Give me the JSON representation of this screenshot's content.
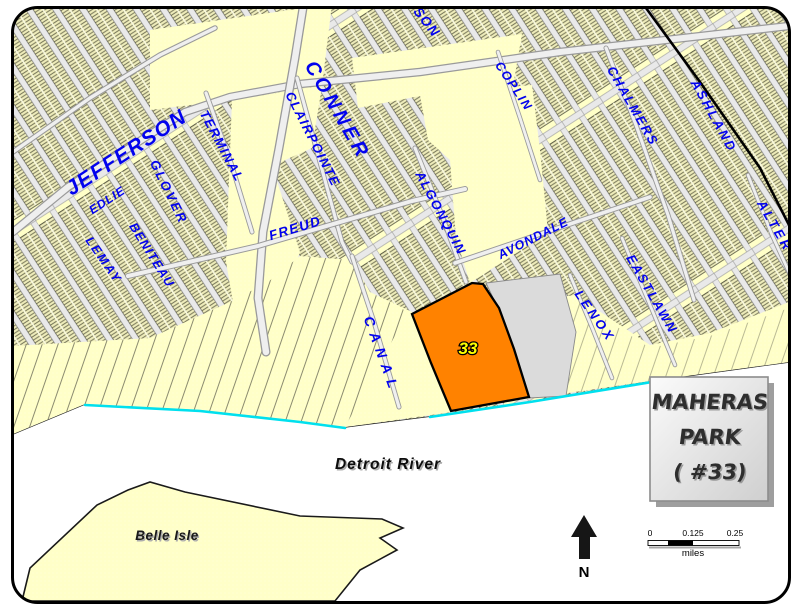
{
  "streets": [
    {
      "name": "JEFFERSON"
    },
    {
      "name": "CONNER"
    },
    {
      "name": "TERMINAL"
    },
    {
      "name": "CLAIRPOINTE"
    },
    {
      "name": "GLOVER"
    },
    {
      "name": "EDLIE"
    },
    {
      "name": "BENITEAU"
    },
    {
      "name": "LEMAY"
    },
    {
      "name": "FREUD"
    },
    {
      "name": "CANAL"
    },
    {
      "name": "ALGONQUIN"
    },
    {
      "name": "AVONDALE"
    },
    {
      "name": "COPLIN"
    },
    {
      "name": "CHALMERS"
    },
    {
      "name": "ASHLAND"
    },
    {
      "name": "ALTER"
    },
    {
      "name": "EASTLAWN"
    },
    {
      "name": "LENOX"
    },
    {
      "name": "SON"
    }
  ],
  "park": {
    "number": "33"
  },
  "water": {
    "river_label": "Detroit River",
    "island_label": "Belle Isle"
  },
  "title_box": {
    "line1": "MAHERAS",
    "line2": "PARK",
    "line3": "( #33)"
  },
  "compass": {
    "label": "N"
  },
  "scale_bar": {
    "tick_start": "0",
    "tick_mid": "0.125",
    "tick_end": "0.25",
    "unit_label": "miles"
  },
  "colors": {
    "park_fill": "#FF8200",
    "park_number_yellow": "#FFFF00",
    "street_label_blue": "#0202EE",
    "land_cream": "#FFFFC8",
    "shoreline_cyan": "#00E0EE",
    "water_white": "#FFFFFF"
  }
}
